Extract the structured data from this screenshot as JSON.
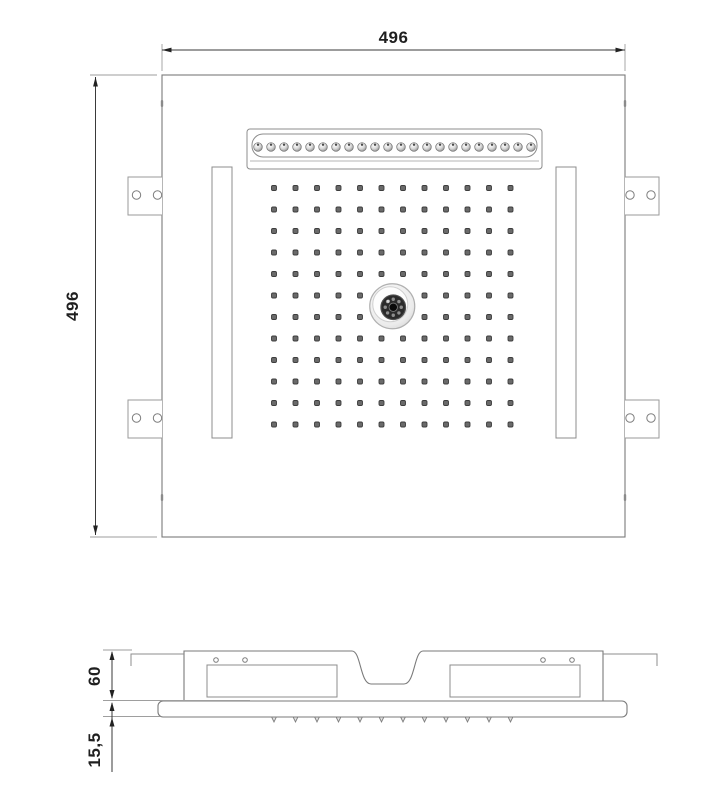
{
  "drawing": {
    "background": "#ffffff",
    "line_color": "#7a7a7a",
    "dim_color": "#1f1f1f",
    "top_view": {
      "width_label": "496",
      "height_label": "496",
      "nozzle_grid": {
        "rows": 12,
        "cols": 12,
        "start_x": 274,
        "start_y": 188,
        "spacing": 21.5,
        "dot_size": 5,
        "hidden_center": true
      },
      "waterfall_nozzles": {
        "count": 22,
        "start_x": 258,
        "y": 147,
        "spacing": 13,
        "radius": 4.3
      },
      "center_fixture": {
        "ring_dots": 8,
        "ring_radius": 8,
        "cx": 392.25,
        "cy": 306.25
      },
      "mounting_tabs": {
        "count": 4,
        "holes_per_tab": 2
      },
      "side_slots": {
        "count": 2
      }
    },
    "side_view": {
      "height_label": "60",
      "depth_label": "15,5",
      "nozzle_ticks": {
        "count": 12,
        "start_x": 274,
        "spacing": 21.5,
        "y": 717
      }
    }
  }
}
